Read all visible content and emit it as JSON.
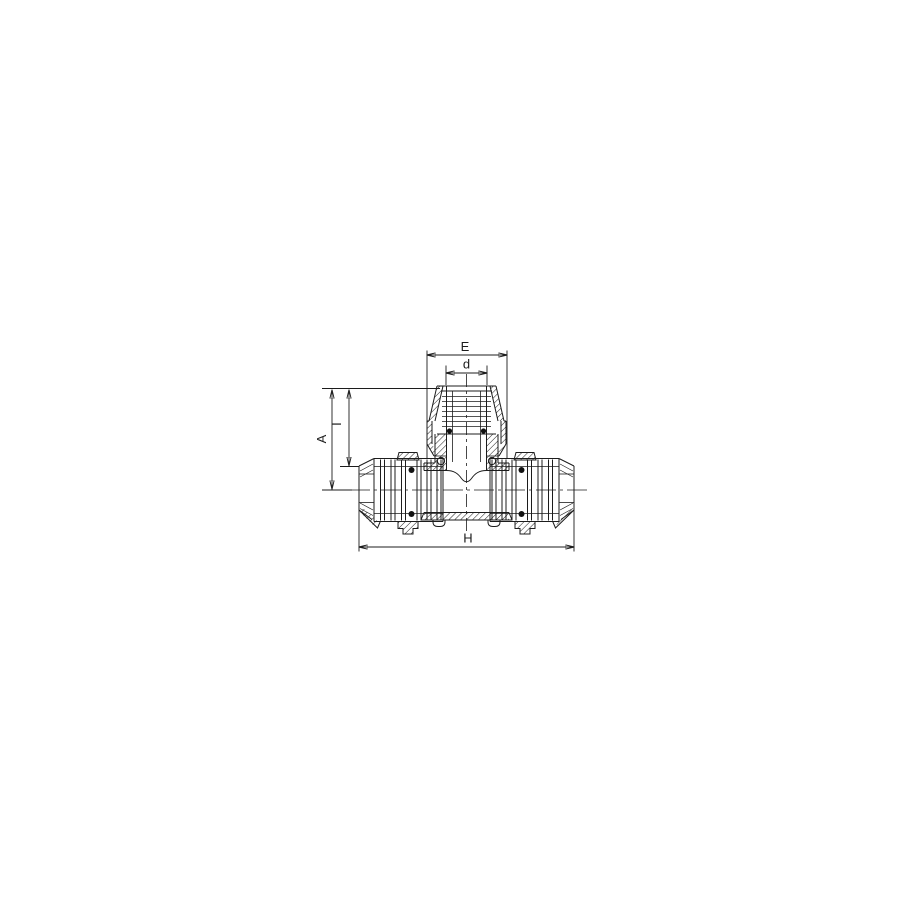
{
  "page": {
    "background_color": "#ffffff"
  },
  "drawing": {
    "name": "compression-tee-fitting-cross-section",
    "style": "black-and-white technical line drawing with section hatching",
    "line_color": "#1c1c1c",
    "dimension_labels": {
      "E": "E",
      "d": "d",
      "A": "A",
      "I": "I",
      "H": "H"
    }
  }
}
